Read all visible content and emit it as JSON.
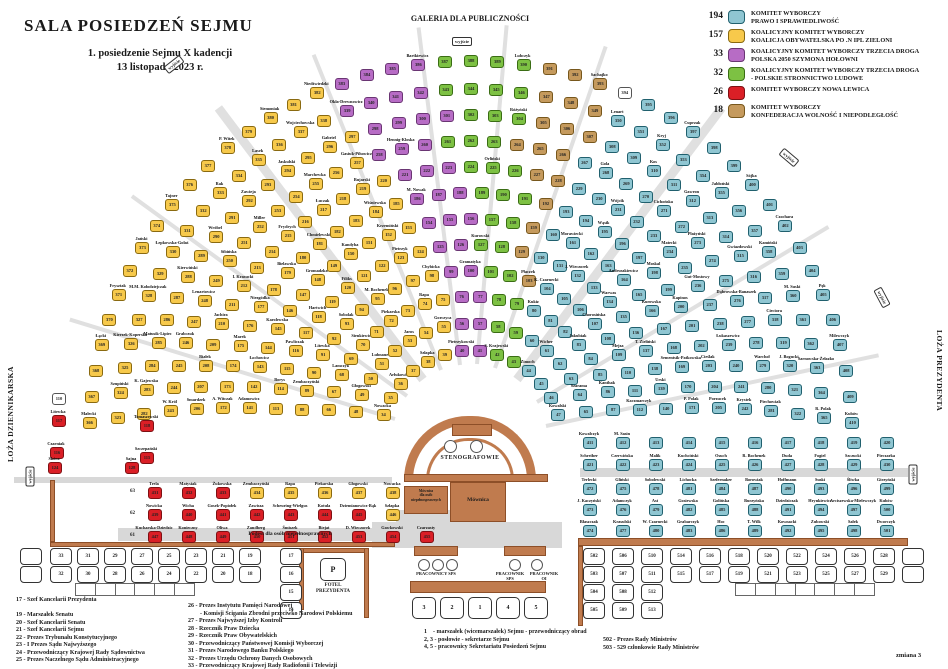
{
  "title": {
    "main": "SALA  POSIEDZEŃ SEJMU",
    "sub1": "1. posiedzenie Sejmu X kadencji",
    "sub2": "13 listopada 2023 r."
  },
  "party_colors": {
    "t": {
      "fill": "#8fc6d2",
      "border": "#20606e"
    },
    "y": {
      "fill": "#f7c94b",
      "border": "#8a6a10"
    },
    "p": {
      "fill": "#b76cc5",
      "border": "#6a3573"
    },
    "g": {
      "fill": "#7dc143",
      "border": "#3a6d14"
    },
    "r": {
      "fill": "#da1f26",
      "border": "#7e1013"
    },
    "b": {
      "fill": "#c59a5d",
      "border": "#77571c"
    },
    "w": {
      "fill": "#ffffff",
      "border": "#555555"
    }
  },
  "legend": {
    "entries": [
      {
        "count": "194",
        "key": "t",
        "lines": [
          "KOMITET WYBORCZY",
          "PRAWO I SPRAWIEDLIWOŚĆ"
        ]
      },
      {
        "count": "157",
        "key": "y",
        "lines": [
          "KOALICYJNY KOMITET WYBORCZY",
          "KOALICJA OBYWATELSKA PO .N IPL ZIELONI"
        ]
      },
      {
        "count": "33",
        "key": "p",
        "lines": [
          "KOALICYJNY KOMITET WYBORCZY TRZECIA DROGA",
          "POLSKA 2050 SZYMONA HOŁOWNI"
        ]
      },
      {
        "count": "32",
        "key": "g",
        "lines": [
          "KOALICYJNY KOMITET WYBORCZY TRZECIA DROGA",
          "- POLSKIE STRONNICTWO LUDOWE"
        ]
      },
      {
        "count": "26",
        "key": "r",
        "lines": [
          "KOMITET WYBORCZY NOWA LEWICA"
        ]
      },
      {
        "count": "18",
        "key": "b",
        "lines": [
          "KOMITET WYBORCZY",
          "KONFEDERACJA WOLNOŚĆ I NIEPODLEGŁOŚĆ"
        ]
      }
    ]
  },
  "labels": {
    "galeria": "GALERIA DLA PUBLICZNOŚCI",
    "wyjscie": "wyjście",
    "loza_left": "LOŻA DZIENNIKARSKA",
    "loza_right": "LOŻA PREZYDENTA",
    "stenografowie": "STENOGRAFOWIE",
    "mownica": "Mównica",
    "mownica_dis": "Mównica\ndla osób\nniepełnosprawnych",
    "podest": "Podest dla osób niepełnosprawnych",
    "fotel_p": "P",
    "fotel": "FOTEL\nPREZYDENTA",
    "pracownicy_sps": "PRACOWNICY  SPS",
    "pracownik_sps": "PRACOWNIK\nSPS",
    "pracownik_oi": "PRACOWNIK\nOI",
    "zmiana": "zmiana 3"
  },
  "exits": [
    {
      "x": 452,
      "y": 37,
      "rot": 0
    },
    {
      "x": 164,
      "y": 60,
      "rot": -38
    },
    {
      "x": 779,
      "y": 153,
      "rot": 40
    },
    {
      "x": 20,
      "y": 472,
      "rot": -90
    },
    {
      "x": 872,
      "y": 293,
      "rot": 62
    },
    {
      "x": 903,
      "y": 470,
      "rot": -90
    }
  ],
  "aisles": [
    {
      "deg": 163,
      "w": 4
    },
    {
      "deg": 144,
      "w": 4
    },
    {
      "deg": 127,
      "w": 9
    },
    {
      "deg": 112,
      "w": 4
    },
    {
      "deg": 97,
      "w": 4
    },
    {
      "deg": 85,
      "w": 4
    },
    {
      "deg": 71,
      "w": 4
    },
    {
      "deg": 53,
      "w": 9
    },
    {
      "deg": 31,
      "w": 4
    },
    {
      "deg": 12,
      "w": 4
    }
  ],
  "fan": {
    "cx": 470,
    "cy": 442,
    "start_number": 34,
    "rows": [
      {
        "r": 92,
        "a0": 162,
        "a1": 18,
        "seg": [
          [
            "y",
            6
          ],
          [
            "p",
            2
          ],
          [
            "g",
            2
          ],
          [
            "t",
            4
          ]
        ]
      },
      {
        "r": 119,
        "a0": 165,
        "a1": 15,
        "seg": [
          [
            "y",
            8
          ],
          [
            "p",
            2
          ],
          [
            "g",
            2
          ],
          [
            "t",
            6
          ]
        ]
      },
      {
        "r": 146,
        "a0": 167,
        "a1": 13,
        "seg": [
          [
            "y",
            10
          ],
          [
            "p",
            2
          ],
          [
            "g",
            2
          ],
          [
            "t",
            8
          ]
        ]
      },
      {
        "r": 172,
        "a0": 169,
        "a1": 11,
        "seg": [
          [
            "y",
            11
          ],
          [
            "p",
            2
          ],
          [
            "g",
            2
          ],
          [
            "b",
            1
          ],
          [
            "t",
            9
          ]
        ]
      },
      {
        "r": 198,
        "a0": 170,
        "a1": 10,
        "seg": [
          [
            "y",
            12
          ],
          [
            "p",
            2
          ],
          [
            "g",
            2
          ],
          [
            "b",
            1
          ],
          [
            "t",
            11
          ]
        ]
      },
      {
        "r": 224,
        "a0": 171,
        "a1": 9,
        "seg": [
          [
            "y",
            13
          ],
          [
            "p",
            3
          ],
          [
            "g",
            2
          ],
          [
            "b",
            1
          ],
          [
            "t",
            12
          ]
        ]
      },
      {
        "r": 250,
        "a0": 172,
        "a1": 8,
        "seg": [
          [
            "y",
            14
          ],
          [
            "p",
            3
          ],
          [
            "g",
            3
          ],
          [
            "b",
            1
          ],
          [
            "t",
            13
          ]
        ]
      },
      {
        "r": 276,
        "a0": 173,
        "a1": 7,
        "seg": [
          [
            "y",
            15
          ],
          [
            "p",
            3
          ],
          [
            "g",
            3
          ],
          [
            "b",
            2
          ],
          [
            "t",
            14
          ]
        ]
      },
      {
        "r": 302,
        "a0": 174,
        "a1": 6,
        "seg": [
          [
            "y",
            15
          ],
          [
            "p",
            3
          ],
          [
            "g",
            3
          ],
          [
            "b",
            3
          ],
          [
            "t",
            15
          ]
        ]
      },
      {
        "r": 328,
        "a0": 175,
        "a1": 5,
        "seg": [
          [
            "y",
            16
          ],
          [
            "p",
            4
          ],
          [
            "g",
            3
          ],
          [
            "b",
            3
          ],
          [
            "t",
            15
          ]
        ]
      },
      {
        "r": 354,
        "a0": 176,
        "a1": 4,
        "seg": [
          [
            "y",
            16
          ],
          [
            "p",
            4
          ],
          [
            "g",
            4
          ],
          [
            "b",
            3
          ],
          [
            "t",
            16
          ]
        ]
      },
      {
        "r": 382,
        "a0": 177,
        "a1": 3,
        "seg": [
          [
            "y",
            17
          ],
          [
            "p",
            4
          ],
          [
            "g",
            4
          ],
          [
            "b",
            3
          ],
          [
            "w",
            1
          ],
          [
            "t",
            16
          ]
        ]
      }
    ]
  },
  "name_pools": {
    "y": [
      "Nowacka",
      "Arłukowicz",
      "Szłapka",
      "Głogowski",
      "Lubnauer",
      "Jaros",
      "Gorczyca",
      "Lamczyk",
      "Sienkiewicz",
      "Piekarska",
      "Rapa",
      "Zembaczyński",
      "Litewka",
      "Sobolak",
      "M. Bochenek",
      "Chybicka",
      "Borys",
      "Pawliczak",
      "Hartwich",
      "Filiks",
      "Pietrzyk",
      "Adamowicz",
      "Łochowicz",
      "Karolewska",
      "Gromadzka",
      "Kandyba",
      "Krzemiński",
      "A. Witczak",
      "Marek",
      "Niezgódka",
      "Bielawska",
      "Chmielewski",
      "Wiśniewska",
      "Smardzek",
      "Białek",
      "Jachira",
      "I. Krasucki",
      "Frydrych",
      "Łuczak",
      "Bujarski",
      "W. Król",
      "Grabczuk",
      "Lenartowicz",
      "Sibińska",
      "Miller",
      "Marchewka",
      "Gasiuk-Pihowicz",
      "K. Gajewska",
      "Matusik-Lipiec",
      "Kierwiński",
      "Wróbel",
      "Zawieja",
      "Jaskulski",
      "Gabriel",
      "Szupiński",
      "Kierzek-Koperska",
      "M.M. Kołodziejczak",
      "Łepkowska-Gołaś",
      "Rak",
      "Lasek",
      "Wojciechowska",
      "Małecki",
      "Łącki",
      "Frysztak",
      "Jański",
      "Tajner",
      "P. Witek",
      "Siemoniak",
      "Niedźwiedzki"
    ],
    "p": [
      "Pietrzykowski",
      "Gramatyka",
      "M. Nowak",
      "Hennig-Kloska",
      "Okła-Drewnowicz",
      "Bartkiewicz"
    ],
    "g": [
      "S. Krajewski",
      "Kurowski",
      "Orliński",
      "Różyński",
      "Lubczyk"
    ],
    "b": [
      "Płaczek",
      "Sachajko"
    ],
    "t": [
      "Zimoch",
      "Kowalski",
      "Wicher",
      "Szarama",
      "Kukiz",
      "Jakubiak",
      "Kanthak",
      "K. Czarnecki",
      "Chorosińska",
      "Mejza",
      "Kaczmarczyk",
      "J. Wieczorek",
      "Warwas",
      "T. Zieliński",
      "Urski",
      "Morawiecki",
      "Andruszkiewicz",
      "Kurowska",
      "Sementsik-Patkowska",
      "P. Polak",
      "Wąsik",
      "Moskal",
      "Kapinos",
      "Cieślak",
      "Porzucek",
      "Wójcik",
      "Matecki",
      "Gut-Mostowy",
      "Łukaszewicz",
      "Krystek",
      "Gola",
      "Cichońska",
      "Płażyński",
      "Dąbrowska-Banaszek",
      "Warchoł",
      "Piechowiak",
      "Kos",
      "Gawron",
      "Gwiazdowski",
      "Cieciora",
      "J. Bogucki",
      "Lenart",
      "Kryj",
      "Jabłoński",
      "Kamiński",
      "M. Suski",
      "Sarnowska-Żełazko",
      "R. Polak",
      "Cuprzak",
      "Sójka",
      "Czochara",
      "Pęk",
      "Milewczyk",
      "Kubów"
    ]
  },
  "right_wing": {
    "x0": 583,
    "dx": 33,
    "rows": [
      {
        "y": 437,
        "names": [
          "Kowalczyk",
          "M. Sasin",
          "",
          "",
          "",
          "",
          "",
          "",
          "",
          ""
        ]
      },
      {
        "y": 459,
        "names": [
          "Schreiber",
          "Czerwińska",
          "Malik",
          "Kuchciński",
          "Osuch",
          "R. Bochenek",
          "Duda",
          "Fogiel",
          "Szczucki",
          "Pieczarka"
        ]
      }
    ]
  },
  "block_472": {
    "x0": 583,
    "dx": 33,
    "ys": [
      483,
      504,
      525
    ],
    "start": 472,
    "names_by_col": [
      [
        "Terlecki",
        "J. Kaczyński",
        "Błaszczak"
      ],
      [
        "Gliński",
        "Adamczyk",
        "Krasulski"
      ],
      [
        "Sobolewski",
        "Ast",
        "W. Czarnecki"
      ],
      [
        "Lichocka",
        "Gosiewska",
        "Grabarczyk"
      ],
      [
        "Szefernaker",
        "Golińska",
        "Hoc"
      ],
      [
        "Borowiak",
        "Burzyńska",
        "T. Wilk"
      ],
      [
        "Hoffmann",
        "Dziedziczak",
        "Kownacki"
      ],
      [
        "Suski",
        "Hrynkiewicz",
        "Zubowski"
      ],
      [
        "Śliwka",
        "Arciszewska-Mielewczyk",
        "Sałek"
      ],
      [
        "Girzyński",
        "Kubów",
        "Dworczyk"
      ]
    ]
  },
  "straight_left": {
    "x0": 148,
    "dx": 34,
    "label_x": 130,
    "row_labels": [
      "63",
      "62",
      "61"
    ],
    "rows": [
      {
        "y": 487,
        "seats": [
          {
            "c": "r",
            "n": "Trela"
          },
          {
            "c": "r",
            "n": "Matysiak"
          },
          {
            "c": "r",
            "n": "Żukowska"
          },
          {
            "c": "y",
            "n": "Zembaczyński"
          },
          {
            "c": "y",
            "n": "Rapa"
          },
          {
            "c": "y",
            "n": "Piekarska"
          },
          {
            "c": "y",
            "n": "Głogowski"
          },
          {
            "c": "y",
            "n": "Nowacka"
          }
        ]
      },
      {
        "y": 509,
        "seats": [
          {
            "c": "r",
            "n": "Nowicka"
          },
          {
            "c": "r",
            "n": "Wicha"
          },
          {
            "c": "r",
            "n": "Gosek-Popiołek"
          },
          {
            "c": "r",
            "n": "Zawisza"
          },
          {
            "c": "r",
            "n": "Scheuring-Wielgus"
          },
          {
            "c": "r",
            "n": "Kotula"
          },
          {
            "c": "r",
            "n": "Dziemianowicz-Bąk"
          },
          {
            "c": "y",
            "n": "Szłapka"
          }
        ]
      },
      {
        "y": 531,
        "seats": [
          {
            "c": "r",
            "n": "Kucharska-Dziedzic"
          },
          {
            "c": "r",
            "n": "Konieczny"
          },
          {
            "c": "r",
            "n": "Oliwa"
          },
          {
            "c": "r",
            "n": "Zandberg"
          },
          {
            "c": "r",
            "n": "Śmiszek"
          },
          {
            "c": "r",
            "n": "Biejat"
          },
          {
            "c": "r",
            "n": "D. Wieczorek"
          },
          {
            "c": "r",
            "n": "Gawkowski"
          },
          {
            "c": "r",
            "n": "Czarzasty"
          }
        ]
      }
    ]
  },
  "extra_seats": [
    {
      "x": 52,
      "y": 393,
      "c": "w",
      "num": "110",
      "n": ""
    },
    {
      "x": 52,
      "y": 415,
      "c": "r",
      "num": "117",
      "n": "Litewka"
    },
    {
      "x": 140,
      "y": 420,
      "c": "r",
      "num": "118",
      "n": "Tomaszewski"
    },
    {
      "x": 50,
      "y": 447,
      "c": "r",
      "num": "116",
      "n": "Czarniak"
    },
    {
      "x": 140,
      "y": 452,
      "c": "r",
      "num": "115",
      "n": "Szczepański"
    },
    {
      "x": 48,
      "y": 462,
      "c": "r",
      "num": "124",
      "n": "Skóra"
    },
    {
      "x": 125,
      "y": 462,
      "c": "r",
      "num": "128",
      "n": "Sajna"
    }
  ],
  "officials_bench": {
    "x0": 50,
    "dx": 27,
    "top_row": {
      "y": 548,
      "numbers": [
        "33",
        "31",
        "29",
        "27",
        "25",
        "23",
        "21",
        "19"
      ]
    },
    "bottom_row": {
      "y": 566,
      "numbers": [
        "32",
        "30",
        "28",
        "26",
        "24",
        "22",
        "20",
        "18"
      ]
    },
    "side_col": {
      "x": 280,
      "ys": [
        548,
        566,
        584,
        602
      ],
      "numbers": [
        "17",
        "16",
        "15",
        "14"
      ]
    },
    "blank_boxes": [
      {
        "x": 20,
        "y": 548
      },
      {
        "x": 20,
        "y": 566
      }
    ]
  },
  "gov_bench": {
    "x0": 583,
    "dx": 29,
    "y0": 548,
    "dy": 18,
    "columns": [
      [
        "502",
        "503",
        "504",
        "505"
      ],
      [
        "506",
        "507",
        "508",
        "509"
      ],
      [
        "510",
        "511",
        "512",
        "513"
      ],
      [
        "514",
        "515"
      ],
      [
        "516",
        "517"
      ],
      [
        "518",
        "519"
      ],
      [
        "520",
        "521"
      ],
      [
        "522",
        "523"
      ],
      [
        "524",
        "525"
      ],
      [
        "526",
        "527"
      ],
      [
        "528",
        "529"
      ]
    ],
    "blank_col": {
      "x": 902,
      "ys": [
        548,
        566
      ]
    }
  },
  "marshal_boxes": {
    "x0": 412,
    "dx": 28,
    "y": 597,
    "labels": [
      "3",
      "2",
      "1",
      "4",
      "5"
    ]
  },
  "lists": {
    "left": [
      "17 - Szef Kancelarii Prezydenta",
      "",
      "19 - Marszałek Senatu",
      "20 - Szef Kancelarii Senatu",
      "21 - Szef Kancelarii Sejmu",
      "22 - Prezes Trybunału Konstytucyjnego",
      "23 - I Prezes Sądu Najwyższego",
      "24 - Przewodniczący Krajowej Rady Sądownictwa",
      "25 - Prezes Naczelnego Sądu Administracyjnego"
    ],
    "middle": [
      "26 - Prezes Instytutu Pamięci Narodowej",
      "        - Komisji Ścigania Zbrodni przeciwko Narodowi Polskiemu",
      "27 - Prezes Najwyższej Izby Kontroli",
      "28 - Rzecznik Praw Dziecka",
      "29 - Rzecznik Praw Obywatelskich",
      "30 - Przewodniczący Państwowej Komisji Wyborczej",
      "31 - Prezes Narodowego Banku Polskiego",
      "32 - Prezes Urzędu Ochrony Danych Osobowych",
      "33 - Przewodniczący Krajowej Rady Radiofonii i Telewizji"
    ],
    "notes": [
      "1    - marszałek (wicemarszałek) Sejmu - przewodniczący obrad",
      "2, 3 - posłowie - sekretarze Sejmu",
      "4, 5 - pracownicy Sekretariatu Posiedzeń Sejmu"
    ],
    "gov_notes": [
      "502 - Prezes Rady Ministrów",
      "503 - 529 członkowie Rady Ministrów"
    ]
  },
  "tables": {
    "left": {
      "x": 75,
      "y": 583,
      "w": 120,
      "h": 13,
      "cells": 6
    },
    "right": {
      "x": 735,
      "y": 583,
      "w": 140,
      "h": 13,
      "cells": 7
    }
  }
}
